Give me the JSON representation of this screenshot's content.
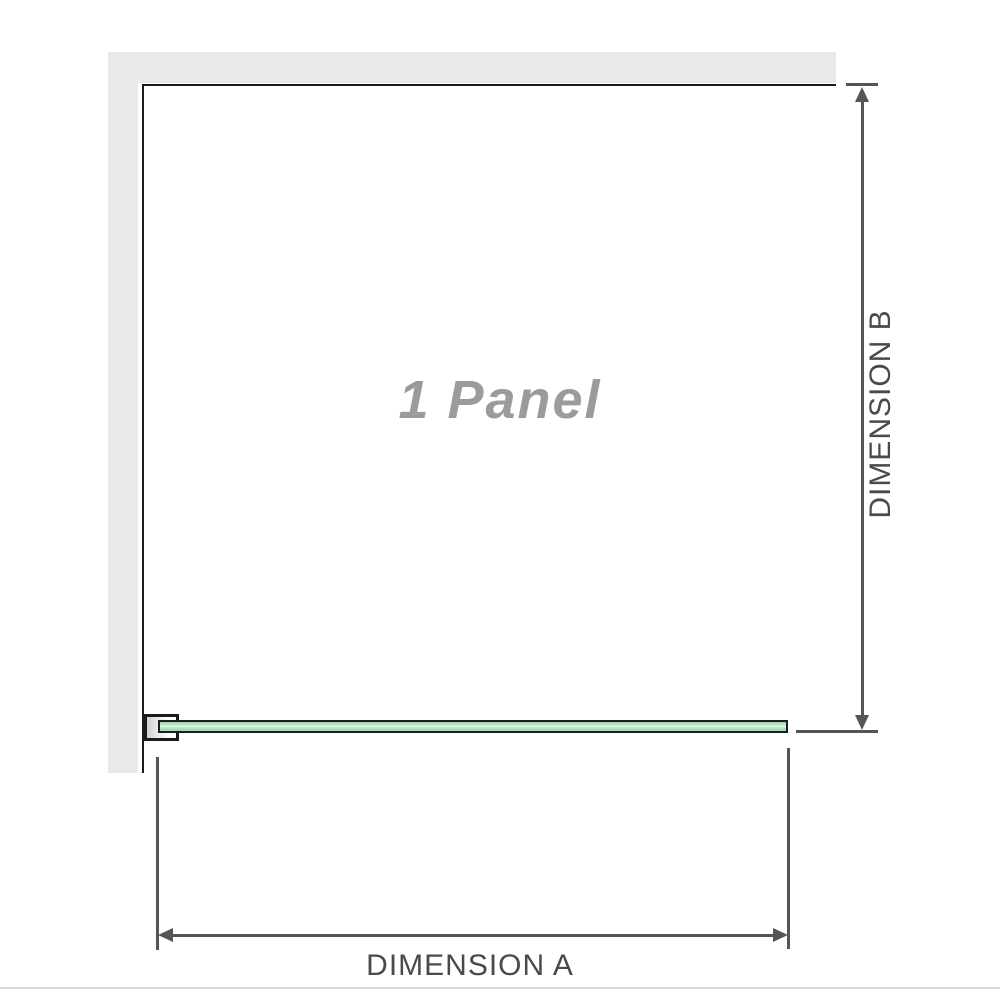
{
  "labels": {
    "panel": "1 Panel",
    "dimension_a": "DIMENSION A",
    "dimension_b": "DIMENSION B"
  },
  "colors": {
    "background": "#ffffff",
    "wall": "#e9e9e9",
    "outline": "#1a1a1a",
    "dimension_line": "#555555",
    "dimension_text": "#4a4a4a",
    "panel_text": "#9b9b9b",
    "glass_green": "#a8dcb9",
    "glass_highlight": "#ecf8f0",
    "separator": "#d9d9d9"
  }
}
